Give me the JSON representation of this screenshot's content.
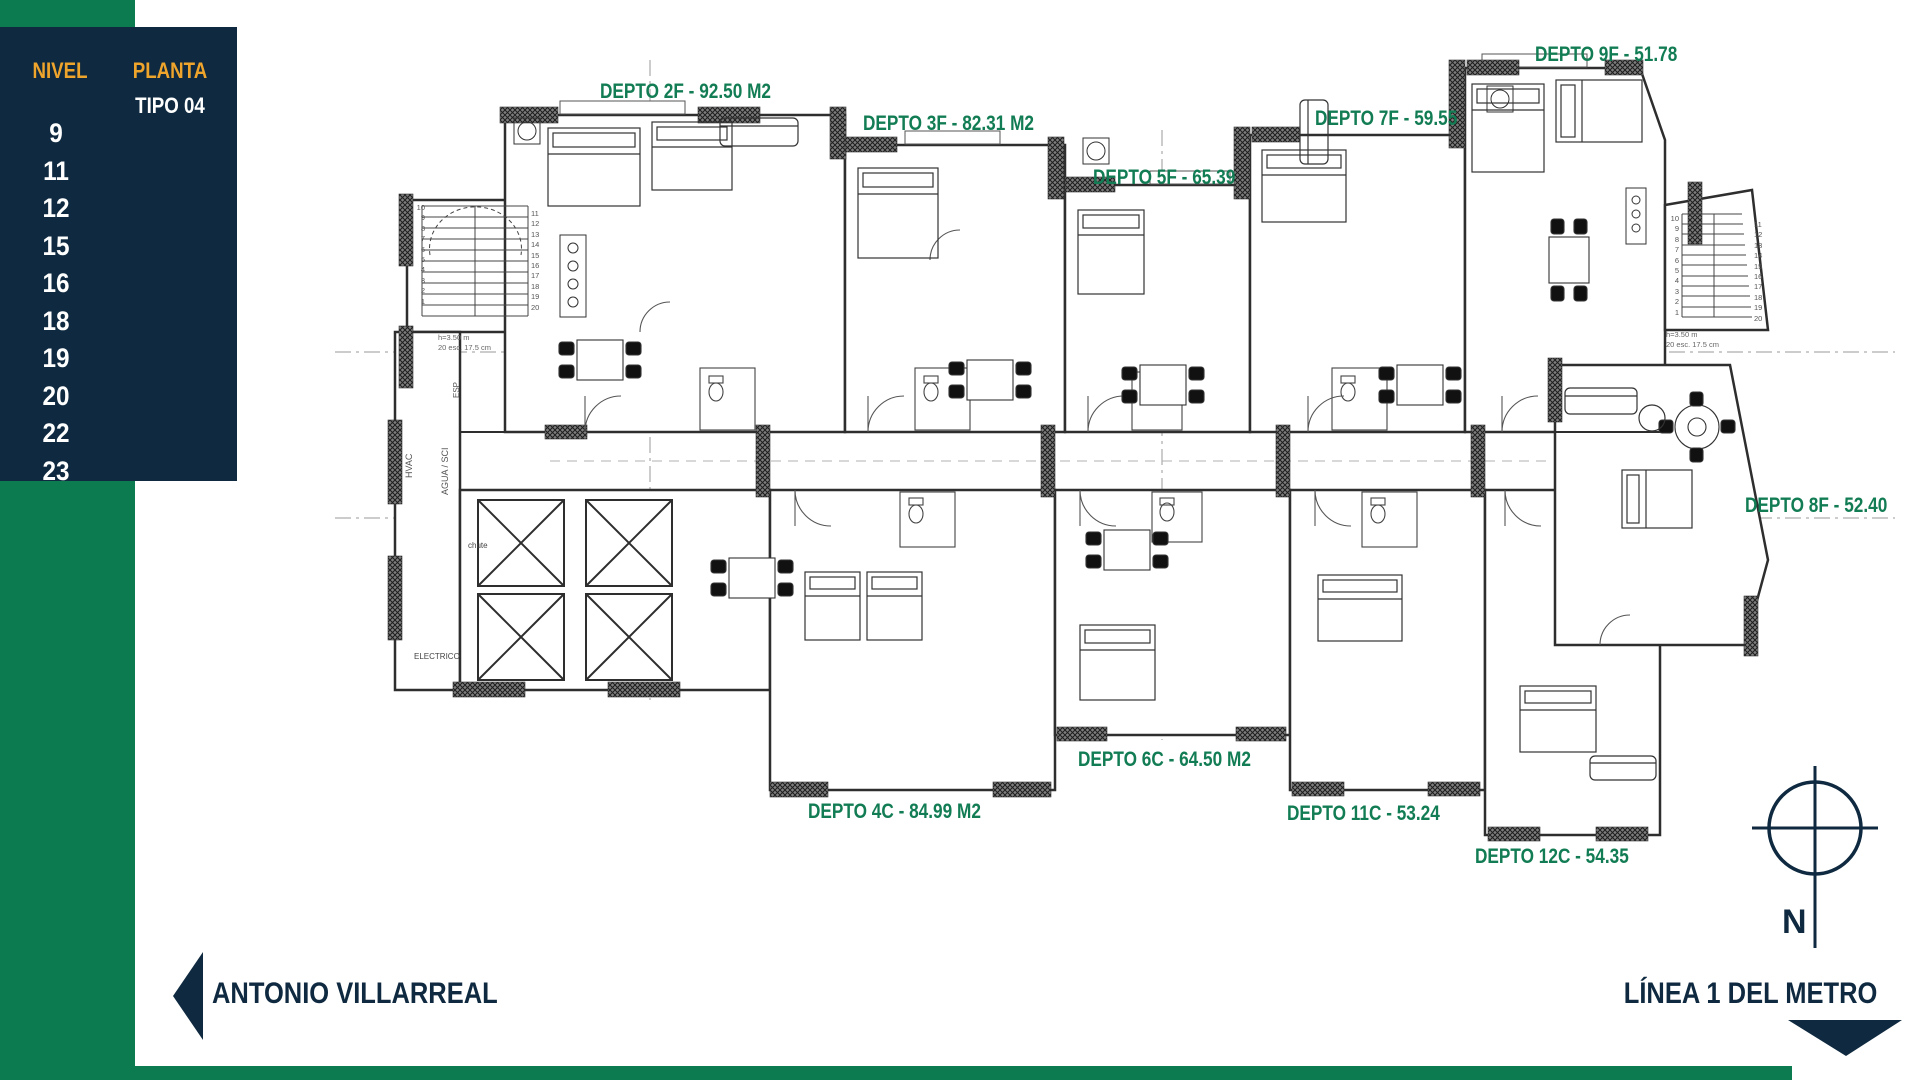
{
  "colors": {
    "navy": "#0f2a40",
    "gold": "#efa42c",
    "green_accent": "#0c7b4f",
    "green_label": "#127c54"
  },
  "level_panel": {
    "nivel_header": "NIVEL",
    "planta_header": "PLANTA",
    "planta_value": "TIPO 04",
    "levels": [
      "9",
      "11",
      "12",
      "15",
      "16",
      "18",
      "19",
      "20",
      "22",
      "23"
    ]
  },
  "units": [
    {
      "id": "2F",
      "label": "DEPTO 2F - 92.50 M2"
    },
    {
      "id": "3F",
      "label": "DEPTO 3F - 82.31 M2"
    },
    {
      "id": "5F",
      "label": "DEPTO 5F - 65.39"
    },
    {
      "id": "7F",
      "label": "DEPTO 7F - 59.55"
    },
    {
      "id": "9F",
      "label": "DEPTO 9F - 51.78"
    },
    {
      "id": "8F",
      "label": "DEPTO 8F - 52.40"
    },
    {
      "id": "6C",
      "label": "DEPTO 6C - 64.50 M2"
    },
    {
      "id": "4C",
      "label": "DEPTO 4C - 84.99 M2"
    },
    {
      "id": "11C",
      "label": "DEPTO 11C - 53.24"
    },
    {
      "id": "12C",
      "label": "DEPTO 12C - 54.35"
    }
  ],
  "streets": {
    "left": "ANTONIO VILLARREAL",
    "right": "LÍNEA 1 DEL METRO"
  },
  "compass": {
    "north_label": "N"
  },
  "plan": {
    "stairs": {
      "left": {
        "col_a": "10\n9\n8\n7\n6\n5\n4\n3\n2\n1",
        "col_b": "11\n12\n13\n14\n15\n16\n17\n18\n19\n20",
        "note": "h=3.50 m\n20 esc. 17.5 cm"
      },
      "right": {
        "col_a": "10\n9\n8\n7\n6\n5\n4\n3\n2\n1",
        "col_b": "11\n12\n13\n14\n15\n16\n17\n18\n19\n20",
        "note": "h=3.50 m\n20 esc. 17.5 cm"
      }
    },
    "services": {
      "hvac": "HVAC",
      "agua": "AGUA / SCI",
      "esp": "ESP",
      "chute": "chute",
      "electrico": "ELECTRICO"
    }
  }
}
